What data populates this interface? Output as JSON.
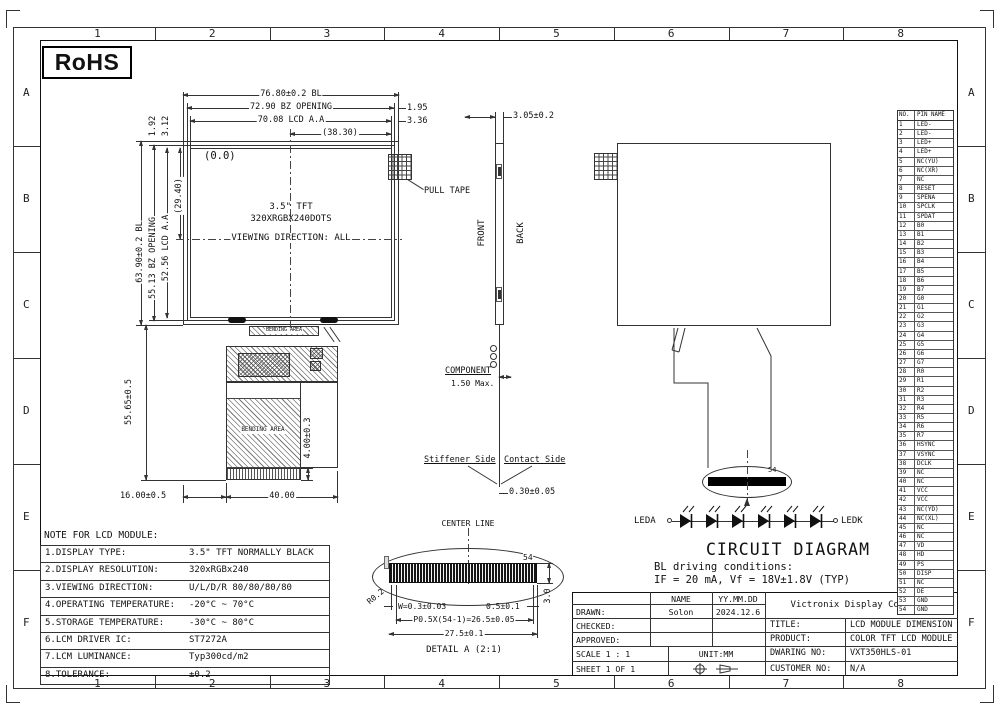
{
  "frame": {
    "cols": [
      "1",
      "2",
      "3",
      "4",
      "5",
      "6",
      "7",
      "8"
    ],
    "rows": [
      "A",
      "B",
      "C",
      "D",
      "E",
      "F"
    ]
  },
  "rohs": "RoHS",
  "front": {
    "dim_bl": "76.80±0.2 BL",
    "dim_bz": "72.90 BZ OPENING",
    "dim_aa": "70.08 LCD A.A",
    "dim_half": "(38.30)",
    "dim_r1": "1.95",
    "dim_r2": "3.36",
    "dimv_bl": "63.90±0.2 BL",
    "dimv_bz": "55.13 BZ OPENING",
    "dimv_aa": "52.56 LCD A.A",
    "dimv_half": "(29.40)",
    "dimt1": "1.92",
    "dimt2": "3.12",
    "origin": "(0.0)",
    "line1": "3.5\" TFT",
    "line2": "320XRGBX240DOTS",
    "line3": "VIEWING DIRECTION: ALL",
    "pull_tape": "PULL TAPE"
  },
  "fpc": {
    "bending": "BENDING AREA",
    "dim_h": "55.65±0.5",
    "dim_tail": "4.00±0.3",
    "dim_off": "16.00±0.5",
    "dim_w": "40.00"
  },
  "side": {
    "dim_top": "3.05±0.2",
    "front": "FRONT",
    "back": "BACK",
    "component": "COMPONENT",
    "component_max": "1.50 Max.",
    "stiffener": "Stiffener Side",
    "contact": "Contact Side",
    "dim_bottom": "0.30±0.05"
  },
  "back": {
    "pin": "54"
  },
  "circuit": {
    "leda": "LEDA",
    "ledk": "LEDK",
    "title": "CIRCUIT DIAGRAM",
    "cond1": "BL driving conditions:",
    "cond2": "IF = 20 mA, Vf = 18V±1.8V (TYP)"
  },
  "detail": {
    "center_line": "CENTER LINE",
    "pin": "54",
    "radius": "R0.2",
    "w": "W=0.3±0.03",
    "gap": "0.5±0.1",
    "pitch": "P0.5X(54-1)=26.5±0.05",
    "total": "27.5±0.1",
    "title": "DETAIL A (2:1)",
    "height": "3.0"
  },
  "notes": {
    "title": "NOTE FOR LCD MODULE:",
    "rows": [
      {
        "label": "1.DISPLAY TYPE:",
        "value": "3.5\" TFT NORMALLY BLACK"
      },
      {
        "label": "2.DISPLAY RESOLUTION:",
        "value": "320xRGBx240"
      },
      {
        "label": "3.VIEWING DIRECTION:",
        "value": "U/L/D/R 80/80/80/80"
      },
      {
        "label": "4.OPERATING TEMPERATURE:",
        "value": "-20°C ~ 70°C"
      },
      {
        "label": "5.STORAGE TEMPERATURE:",
        "value": "-30°C ~ 80°C"
      },
      {
        "label": "6.LCM DRIVER IC:",
        "value": "ST7272A"
      },
      {
        "label": "7.LCM LUMINANCE:",
        "value": "Typ300cd/m2"
      },
      {
        "label": "8.TOLERANCE:",
        "value": "±0.2"
      }
    ]
  },
  "tb": {
    "name": "NAME",
    "date": "YY.MM.DD",
    "drawn": "DRAWN:",
    "drawn_name": "Solon",
    "drawn_date": "2024.12.6",
    "checked": "CHECKED:",
    "approved": "APPROVED:",
    "scale": "SCALE 1 : 1",
    "unit": "UNIT:MM",
    "sheet": "SHEET 1 OF 1",
    "company": "Victronix Display Co., LTD",
    "title_l": "TITLE:",
    "title_v": "LCD MODULE DIMENSION",
    "product_l": "PRODUCT:",
    "product_v": "COLOR TFT LCD MODULE",
    "dwg_l": "DWARING NO:",
    "dwg_v": "VXT350HLS-01",
    "cust_l": "CUSTOMER NO:",
    "cust_v": "N/A"
  },
  "pins": {
    "no": "NO.",
    "name": "PIN NAME",
    "rows": [
      [
        "1",
        "LED-"
      ],
      [
        "2",
        "LED-"
      ],
      [
        "3",
        "LED+"
      ],
      [
        "4",
        "LED+"
      ],
      [
        "5",
        "NC(YU)"
      ],
      [
        "6",
        "NC(XR)"
      ],
      [
        "7",
        "NC"
      ],
      [
        "8",
        "RESET"
      ],
      [
        "9",
        "SPENA"
      ],
      [
        "10",
        "SPCLK"
      ],
      [
        "11",
        "SPDAT"
      ],
      [
        "12",
        "B0"
      ],
      [
        "13",
        "B1"
      ],
      [
        "14",
        "B2"
      ],
      [
        "15",
        "B3"
      ],
      [
        "16",
        "B4"
      ],
      [
        "17",
        "B5"
      ],
      [
        "18",
        "B6"
      ],
      [
        "19",
        "B7"
      ],
      [
        "20",
        "G0"
      ],
      [
        "21",
        "G1"
      ],
      [
        "22",
        "G2"
      ],
      [
        "23",
        "G3"
      ],
      [
        "24",
        "G4"
      ],
      [
        "25",
        "G5"
      ],
      [
        "26",
        "G6"
      ],
      [
        "27",
        "G7"
      ],
      [
        "28",
        "R0"
      ],
      [
        "29",
        "R1"
      ],
      [
        "30",
        "R2"
      ],
      [
        "31",
        "R3"
      ],
      [
        "32",
        "R4"
      ],
      [
        "33",
        "R5"
      ],
      [
        "34",
        "R6"
      ],
      [
        "35",
        "R7"
      ],
      [
        "36",
        "HSYNC"
      ],
      [
        "37",
        "VSYNC"
      ],
      [
        "38",
        "DCLK"
      ],
      [
        "39",
        "NC"
      ],
      [
        "40",
        "NC"
      ],
      [
        "41",
        "VCC"
      ],
      [
        "42",
        "VCC"
      ],
      [
        "43",
        "NC(YD)"
      ],
      [
        "44",
        "NC(XL)"
      ],
      [
        "45",
        "NC"
      ],
      [
        "46",
        "NC"
      ],
      [
        "47",
        "VD"
      ],
      [
        "48",
        "HD"
      ],
      [
        "49",
        "PS"
      ],
      [
        "50",
        "DISP"
      ],
      [
        "51",
        "NC"
      ],
      [
        "52",
        "DE"
      ],
      [
        "53",
        "GND"
      ],
      [
        "54",
        "GND"
      ]
    ]
  }
}
